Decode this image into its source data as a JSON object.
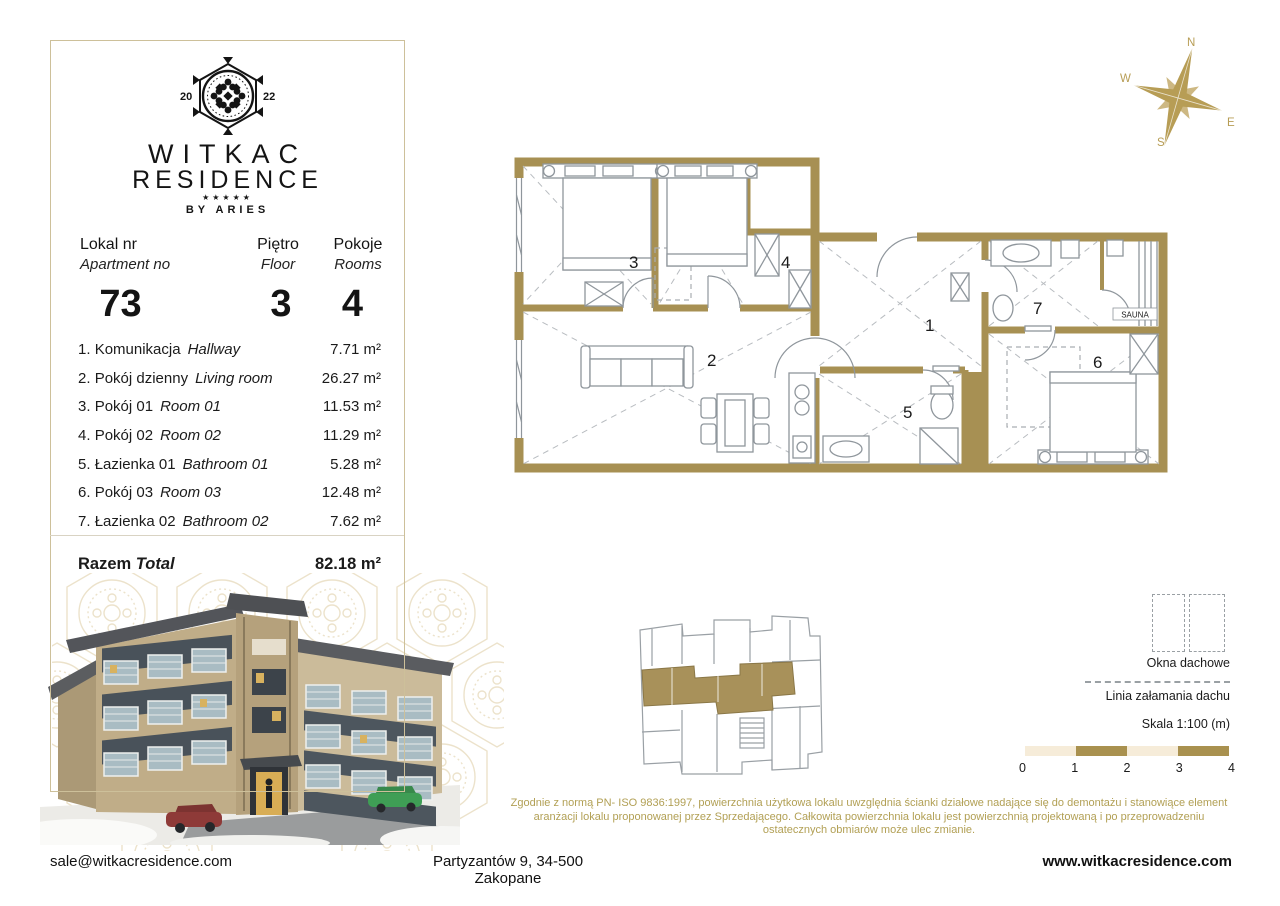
{
  "brand": {
    "year_left": "20",
    "year_right": "22",
    "name_line1": "WITKAC",
    "name_line2": "RESIDENCE",
    "stars": "★★★★★",
    "byline": "BY ARIES"
  },
  "header": {
    "apartment_label_pl": "Lokal nr",
    "apartment_label_en": "Apartment no",
    "apartment_value": "73",
    "floor_label_pl": "Piętro",
    "floor_label_en": "Floor",
    "floor_value": "3",
    "rooms_label_pl": "Pokoje",
    "rooms_label_en": "Rooms",
    "rooms_value": "4"
  },
  "room_list": [
    {
      "num": "1.",
      "name_pl": "Komunikacja",
      "name_en": "Hallway",
      "area": "7.71 m²"
    },
    {
      "num": "2.",
      "name_pl": "Pokój dzienny",
      "name_en": "Living room",
      "area": "26.27 m²"
    },
    {
      "num": "3.",
      "name_pl": "Pokój 01",
      "name_en": "Room 01",
      "area": "11.53 m²"
    },
    {
      "num": "4.",
      "name_pl": "Pokój 02",
      "name_en": "Room 02",
      "area": "11.29 m²"
    },
    {
      "num": "5.",
      "name_pl": "Łazienka 01",
      "name_en": "Bathroom 01",
      "area": "5.28 m²"
    },
    {
      "num": "6.",
      "name_pl": "Pokój 03",
      "name_en": "Room 03",
      "area": "12.48 m²"
    },
    {
      "num": "7.",
      "name_pl": "Łazienka 02",
      "name_en": "Bathroom 02",
      "area": "7.62 m²"
    }
  ],
  "total": {
    "label_pl": "Razem",
    "label_en": "Total",
    "area": "82.18 m²"
  },
  "plan": {
    "labels": {
      "r1": "1",
      "r2": "2",
      "r3": "3",
      "r4": "4",
      "r5": "5",
      "r6": "6",
      "r7": "7"
    },
    "sauna": "SAUNA"
  },
  "compass": {
    "n": "N",
    "e": "E",
    "s": "S",
    "w": "W"
  },
  "legend": {
    "roof_windows": "Okna dachowe",
    "roof_break_line": "Linia załamania dachu",
    "scale": "Skala 1:100 (m)",
    "ticks": [
      "0",
      "1",
      "2",
      "3",
      "4"
    ]
  },
  "disclaimer": "Zgodnie z normą PN- ISO 9836:1997, powierzchnia użytkowa lokalu uwzględnia ścianki działowe nadające się do demontażu i stanowiące element aranżacji lokalu proponowanej przez Sprzedającego. Całkowita powierzchnia lokalu jest powierzchnią projektowaną i po przeprowadzeniu ostatecznych obmiarów może ulec zmianie.",
  "footer": {
    "email": "sale@witkacresidence.com",
    "address": "Partyzantów 9, 34-500 Zakopane",
    "website": "www.witkacresidence.com"
  },
  "colors": {
    "wall_gold": "#a79053",
    "accent_gold": "#b2a055",
    "compass_gold": "#b79d55",
    "watermark": "#e9dec2",
    "scale_cream": "#f6ecd9",
    "scale_gold": "#a9914f",
    "panel_border": "#cdc09a"
  }
}
